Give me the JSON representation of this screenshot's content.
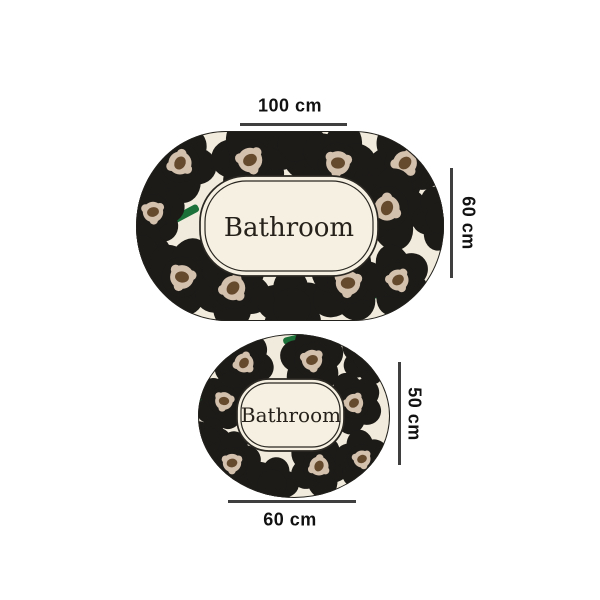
{
  "page": {
    "background": "#ffffff"
  },
  "mats": {
    "large": {
      "name_label": "Bathroom",
      "width_label": "100 cm",
      "height_label": "60 cm"
    },
    "small": {
      "name_label": "Bathroom",
      "width_label": "60 cm",
      "height_label": "50 cm"
    }
  },
  "colors": {
    "mat_background": "#f0ebdc",
    "panel_background": "#f5f0e1",
    "petal": "#1d1b18",
    "flower_center": "#d3c0ad",
    "flower_core": "#664a2e",
    "stem": "#1a7038",
    "mat_outline": "#23211d",
    "panel_outline": "#2a2722",
    "mat_text": "#26211a",
    "dimension_line": "#3f3f3f",
    "dimension_text": "#111111"
  },
  "pattern": {
    "large": {
      "shape": "stadium",
      "w": 310,
      "h": 192,
      "rx": 90,
      "stem": [
        30,
        8
      ],
      "panel": {
        "x": 65,
        "y": 46,
        "w": 178,
        "h": 100,
        "r": 46,
        "inset": 5
      },
      "flowers": [
        [
          45,
          33,
          34,
          1,
          10
        ],
        [
          115,
          30,
          36,
          1,
          40
        ],
        [
          160,
          14,
          30,
          0,
          0
        ],
        [
          203,
          33,
          35,
          1,
          70
        ],
        [
          270,
          33,
          35,
          1,
          25
        ],
        [
          18,
          82,
          30,
          1,
          55
        ],
        [
          252,
          78,
          37,
          1,
          0
        ],
        [
          307,
          88,
          28,
          0,
          30
        ],
        [
          8,
          120,
          25,
          0,
          0
        ],
        [
          47,
          147,
          35,
          1,
          80
        ],
        [
          98,
          158,
          36,
          1,
          20
        ],
        [
          157,
          177,
          33,
          0,
          50
        ],
        [
          213,
          153,
          36,
          1,
          65
        ],
        [
          263,
          150,
          31,
          1,
          35
        ]
      ],
      "stems": [
        [
          160,
          9,
          -12
        ],
        [
          50,
          84,
          -28
        ],
        [
          74,
          166,
          14
        ],
        [
          230,
          166,
          -8
        ],
        [
          152,
          186,
          0
        ]
      ],
      "text": {
        "x": 154,
        "y": 106,
        "size": 26
      }
    },
    "small": {
      "shape": "ellipse",
      "w": 194,
      "h": 166,
      "stem": [
        22,
        7
      ],
      "panel": {
        "x": 40,
        "y": 46,
        "w": 107,
        "h": 72,
        "r": 32,
        "inset": 4
      },
      "flowers": [
        [
          47,
          30,
          28,
          1,
          15
        ],
        [
          115,
          27,
          30,
          1,
          50
        ],
        [
          170,
          24,
          24,
          0,
          0
        ],
        [
          27,
          68,
          26,
          1,
          75
        ],
        [
          157,
          70,
          27,
          1,
          30
        ],
        [
          12,
          106,
          20,
          0,
          0
        ],
        [
          35,
          130,
          27,
          1,
          60
        ],
        [
          75,
          151,
          25,
          0,
          0
        ],
        [
          122,
          133,
          28,
          1,
          5
        ],
        [
          165,
          126,
          25,
          1,
          45
        ]
      ],
      "stems": [
        [
          97,
          6,
          -14
        ],
        [
          9,
          74,
          45
        ],
        [
          142,
          143,
          -5
        ],
        [
          88,
          156,
          8
        ]
      ],
      "text": {
        "x": 94,
        "y": 89,
        "size": 20
      }
    }
  }
}
